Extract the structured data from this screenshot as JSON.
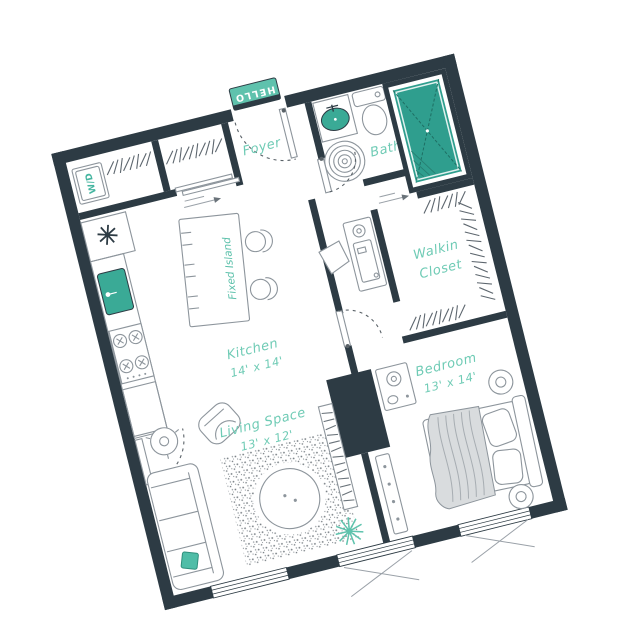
{
  "image": {
    "type": "apartment-floor-plan",
    "background": "#ffffff",
    "plan_rotation_deg": -14
  },
  "palette": {
    "wall": "#2d3b44",
    "shower_teal": "#2f9e8e",
    "fixture_teal": "#3aaa96",
    "doormat_teal": "#5fc2ad",
    "label_teal": "#6fcbb5",
    "furniture_outline": "#8d959c",
    "blanket_gray": "#d9dcde"
  },
  "rooms": {
    "foyer": {
      "label": "Foyer"
    },
    "bath": {
      "label": "Bath"
    },
    "walkin_closet": {
      "line1": "Walkin",
      "line2": "Closet"
    },
    "kitchen": {
      "label": "Kitchen",
      "dims": "14' x 14'"
    },
    "living": {
      "label": "Living Space",
      "dims": "13' x 12'"
    },
    "bedroom": {
      "label": "Bedroom",
      "dims": "13' x 14'"
    }
  },
  "features": {
    "island_label": "Fixed Island",
    "doormat_text": "HELLO",
    "washer_dryer": "W/D"
  }
}
